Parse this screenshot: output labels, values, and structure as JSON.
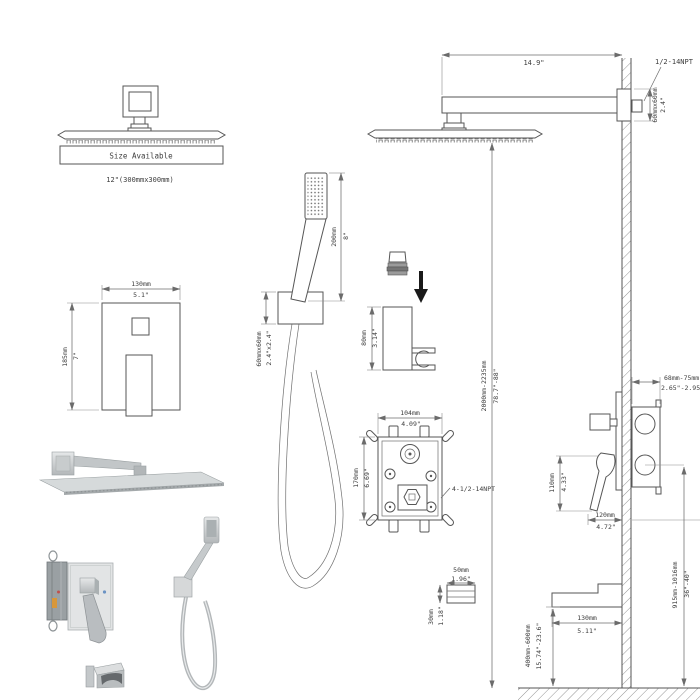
{
  "colors": {
    "background": "#ffffff",
    "line": "#565656",
    "dimension_line": "#6b6b6b",
    "text": "#3d3d3d",
    "metal_light": "#e2e4e5",
    "metal_mid": "#bfc3c5",
    "metal_dark": "#9aa0a3",
    "arrow_black": "#1a1a1a"
  },
  "overhead_head": {
    "box_label": "Size Available",
    "size_text": "12\"(300mmx300mm)"
  },
  "arm": {
    "length_in": "14.9\"",
    "thread": "1/2-14NPT",
    "flange_mm": "60mmx60mm",
    "flange_in": "2.4\""
  },
  "height_dim": {
    "mm": "2000mm-2235mm",
    "inch": "78.7\"-88\""
  },
  "valve_front": {
    "width_mm": "130mm",
    "width_in": "5.1\"",
    "height_mm": "185mm",
    "height_in": "7\""
  },
  "hand_shower": {
    "length_mm": "200mm",
    "length_in": "8\"",
    "bracket_mm": "60mmx60mm",
    "bracket_in": "2.4\"x2.4\""
  },
  "holder": {
    "height_mm": "80mm",
    "height_in": "3.14\""
  },
  "rough_in": {
    "width_mm": "104mm",
    "width_in": "4.09\"",
    "height_mm": "170mm",
    "height_in": "6.69\"",
    "thread": "4-1/2-14NPT"
  },
  "side_view": {
    "depth_mm": "68mm-75mm",
    "depth_in": "2.65\"-2.95\"",
    "handle_mm": "110mm",
    "handle_in": "4.33\"",
    "projection_mm": "120mm",
    "projection_in": "4.72\"",
    "valve_height_mm": "915mm-1016mm",
    "valve_height_in": "36\"-40\""
  },
  "spout": {
    "length_mm": "130mm",
    "length_in": "5.11\"",
    "height_mm": "400mm-600mm",
    "height_in": "15.74\"-23.6\"",
    "section_w_mm": "50mm",
    "section_w_in": "1.96\"",
    "section_h_mm": "30mm",
    "section_h_in": "1.18\""
  }
}
